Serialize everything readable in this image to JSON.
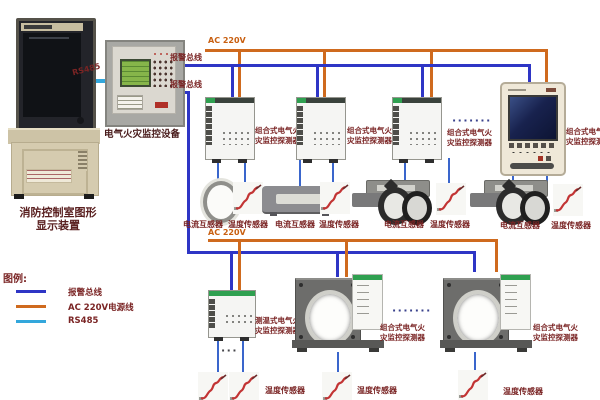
{
  "colors": {
    "alarm_bus": "#2e35c5",
    "ac_power": "#cf6a1e",
    "rs485": "#33a7dc",
    "sensor_link": "#3a66cc",
    "label_text": "#7a2424",
    "green_accent": "#2fa050"
  },
  "workstation": {
    "label_line1": "消防控制室图形",
    "label_line2": "显示装置"
  },
  "links": {
    "rs485_label": "RS485",
    "alarm_bus_label_top": "报警总线",
    "alarm_bus_label_bottom": "报警总线",
    "ac_label_top": "AC 220V",
    "ac_label_bottom": "AC 220V"
  },
  "controller": {
    "label": "电气火灾监控设备"
  },
  "detector_labels": {
    "combined_line1": "组合式电气火",
    "combined_line2": "灾监控探测器",
    "temp_type_line1": "测温式电气火",
    "temp_type_line2": "灾监控探测器"
  },
  "sensor_labels": {
    "current_transformer": "电流互感器",
    "temperature_sensor": "温度传感器"
  },
  "ellipsis": {
    "long": "·······",
    "short": "···"
  },
  "legend": {
    "title": "图例:",
    "items": [
      {
        "label": "报警总线",
        "color": "#2e35c5"
      },
      {
        "label": "AC 220V电源线",
        "color": "#cf6a1e"
      },
      {
        "label": "RS485",
        "color": "#33a7dc"
      }
    ]
  }
}
